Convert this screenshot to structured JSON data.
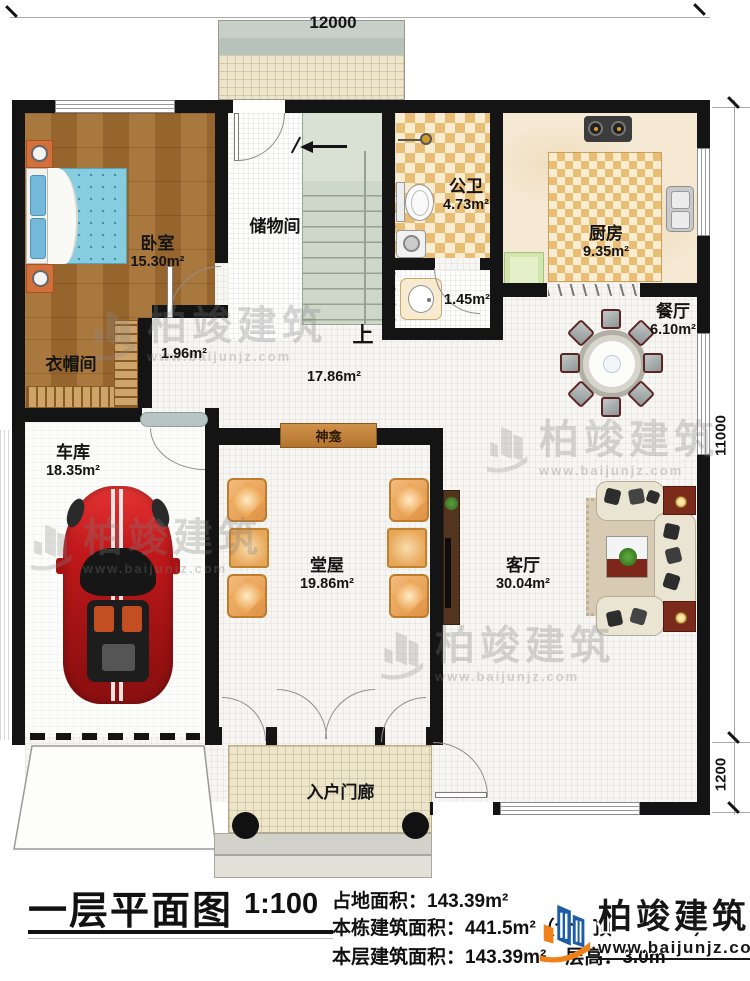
{
  "dimensions": {
    "top": "12000",
    "right_main": "11000",
    "right_porch": "1200"
  },
  "rooms": {
    "bedroom": {
      "label": "卧室",
      "area": "15.30m²"
    },
    "storage": {
      "label": "储物间"
    },
    "bath": {
      "label": "公卫",
      "area": "4.73m²"
    },
    "wash": {
      "area": "1.45m²"
    },
    "kitchen": {
      "label": "厨房",
      "area": "9.35m²"
    },
    "dining": {
      "label": "餐厅",
      "area": "6.10m²"
    },
    "hall": {
      "area": "17.86m²"
    },
    "corridor": {
      "area": "1.96m²"
    },
    "cloakroom": {
      "label": "衣帽间"
    },
    "garage": {
      "label": "车库",
      "area": "18.35m²"
    },
    "main_hall": {
      "label": "堂屋",
      "area": "19.86m²"
    },
    "living": {
      "label": "客厅",
      "area": "30.04m²"
    },
    "porch": {
      "label": "入户门廊"
    },
    "shrine": {
      "label": "神龛"
    },
    "stairs": {
      "label": "上"
    }
  },
  "title_block": {
    "title": "一层平面图",
    "scale": "1:100",
    "land_area": "占地面积：143.39m²",
    "total_area": "本栋建筑面积：441.5m²（含　顶　　　　²）",
    "floor_area": "本层建筑面积：143.39m²　层高：3.0m"
  },
  "branding": {
    "name": "柏竣建筑",
    "url": "www.baijunjz.com"
  },
  "colors": {
    "wall": "#141414",
    "wood": "#a9783f",
    "checker": "#eabd74",
    "car_red": "#c1181b",
    "brand_blue": "#1d5ca6",
    "brand_orange": "#f08019"
  }
}
